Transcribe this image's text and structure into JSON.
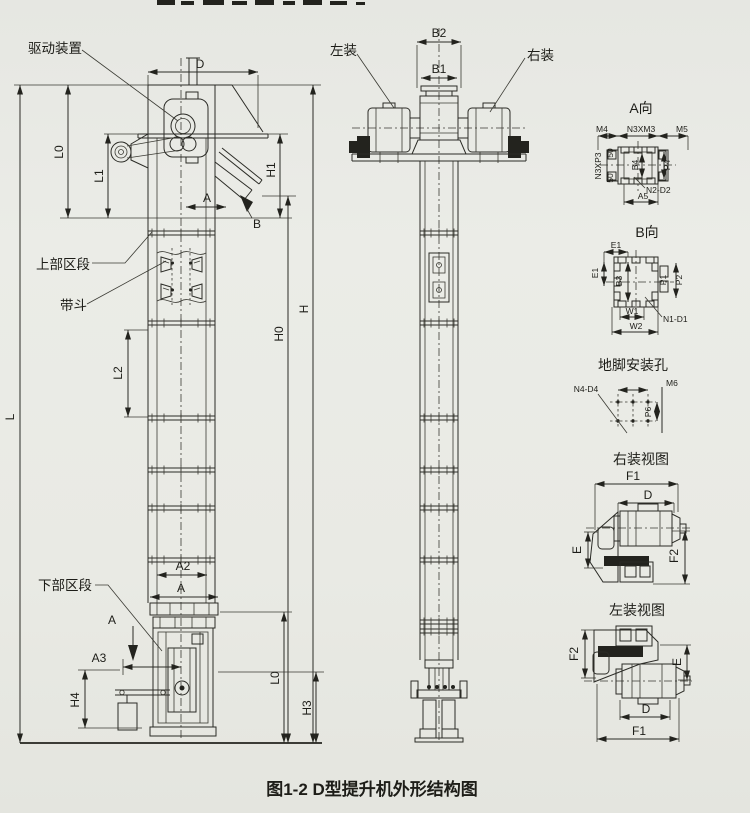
{
  "page": {
    "caption": "图1-2  D型提升机外形结构图"
  },
  "front_view": {
    "labels": {
      "drive_unit": "驱动装置",
      "upper_section": "上部区段",
      "bucket": "带斗",
      "lower_section": "下部区段"
    },
    "dims": {
      "D": "D",
      "L0": "L0",
      "L1": "L1",
      "H1": "H1",
      "A_head": "A",
      "B": "B",
      "L": "L",
      "L2": "L2",
      "H0": "H0",
      "H": "H",
      "A2": "A2",
      "A_boot": "A",
      "A_section": "A",
      "A3": "A3",
      "H4": "H4",
      "L0_bottom": "L0",
      "H3": "H3"
    }
  },
  "side_view": {
    "labels": {
      "left_mount": "左装",
      "right_mount": "右装"
    },
    "dims": {
      "B2": "B2",
      "B1": "B1"
    }
  },
  "view_a": {
    "title": "A向",
    "dims": {
      "M4": "M4",
      "N3M3": "N3XM3",
      "M5": "M5",
      "N3P3": "N3XP3",
      "t50": "50",
      "b50": "50",
      "B4": "B4",
      "P4": "P4",
      "N2D2": "N2-D2",
      "A5": "A5"
    }
  },
  "view_b": {
    "title": "B向",
    "dims": {
      "E1_top": "E1",
      "E1_left": "E1",
      "B3": "B3",
      "P1": "P1",
      "P2": "P2",
      "W1": "W1",
      "W2": "W2",
      "N1D1": "N1-D1"
    }
  },
  "anchor_view": {
    "title": "地脚安装孔",
    "dims": {
      "N4D4": "N4-D4",
      "M6": "M6",
      "P6": "P6"
    }
  },
  "right_mount_view": {
    "title": "右装视图",
    "dims": {
      "F1": "F1",
      "D": "D",
      "E": "E",
      "F2": "F2"
    }
  },
  "left_mount_view": {
    "title": "左装视图",
    "dims": {
      "F2": "F2",
      "E": "E",
      "D": "D",
      "F1": "F1"
    }
  }
}
